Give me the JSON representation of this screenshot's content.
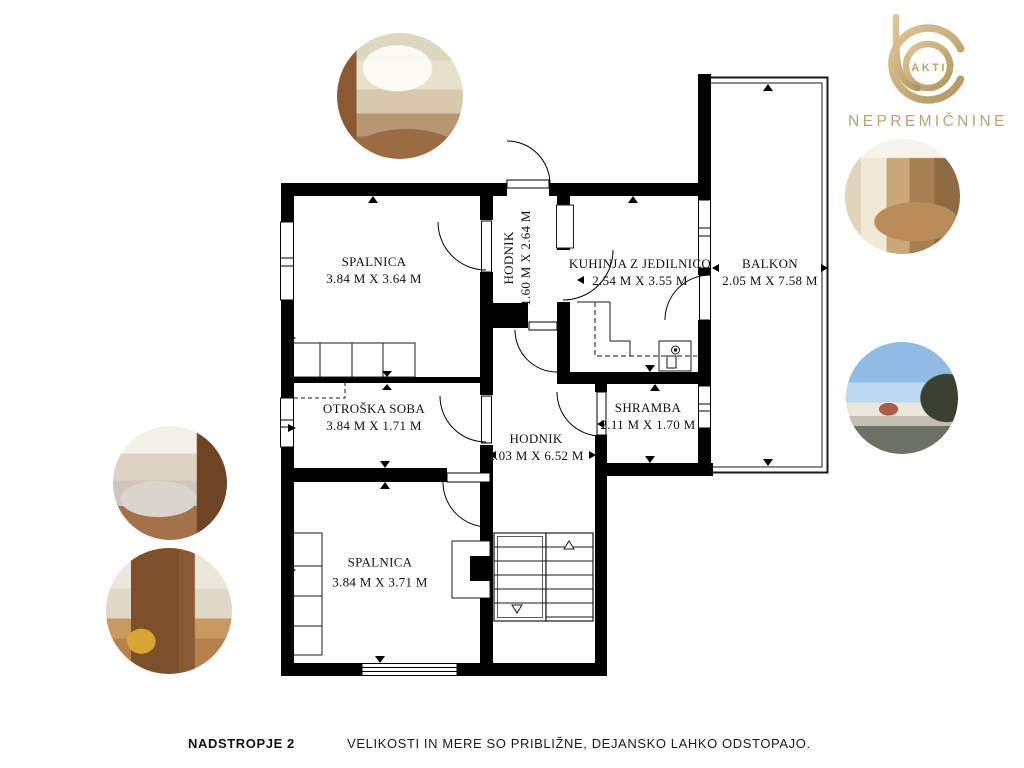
{
  "brand": {
    "monogram_label": "AKTIV",
    "name": "NEPREMIČNINE",
    "gold": "#c2a46f"
  },
  "floor_plan": {
    "rooms": [
      {
        "id": "spalnica-top",
        "name": "SPALNICA",
        "dims": "3.84 M X 3.64 M"
      },
      {
        "id": "hodnik-top",
        "name": "HODNIK",
        "dims": "1.60 M X 2.64 M"
      },
      {
        "id": "kuhinja",
        "name": "KUHINJA Z JEDILNICO",
        "dims": "2.54 M X 3.55 M"
      },
      {
        "id": "balkon",
        "name": "BALKON",
        "dims": "2.05 M X 7.58 M"
      },
      {
        "id": "otroska-soba",
        "name": "OTROŠKA SOBA",
        "dims": "3.84 M X 1.71 M"
      },
      {
        "id": "hodnik-main",
        "name": "HODNIK",
        "dims": "2.03 M X 6.52 M"
      },
      {
        "id": "shramba",
        "name": "SHRAMBA",
        "dims": "2.11 M X 1.70 M"
      },
      {
        "id": "spalnica-bottom",
        "name": "SPALNICA",
        "dims": "3.84 M X 3.71 M"
      }
    ],
    "colors": {
      "wall": "#000000",
      "line": "#1a1a1a"
    }
  },
  "photos": [
    {
      "name": "bedroom-photo-top"
    },
    {
      "name": "kitchen-photo"
    },
    {
      "name": "balcony-view-photo"
    },
    {
      "name": "bedroom-photo-left"
    },
    {
      "name": "wardrobe-room-photo"
    }
  ],
  "footer": {
    "floor_label": "NADSTROPJE 2",
    "disclaimer": "VELIKOSTI IN MERE SO PRIBLIŽNE, DEJANSKO LAHKO ODSTOPAJO."
  }
}
